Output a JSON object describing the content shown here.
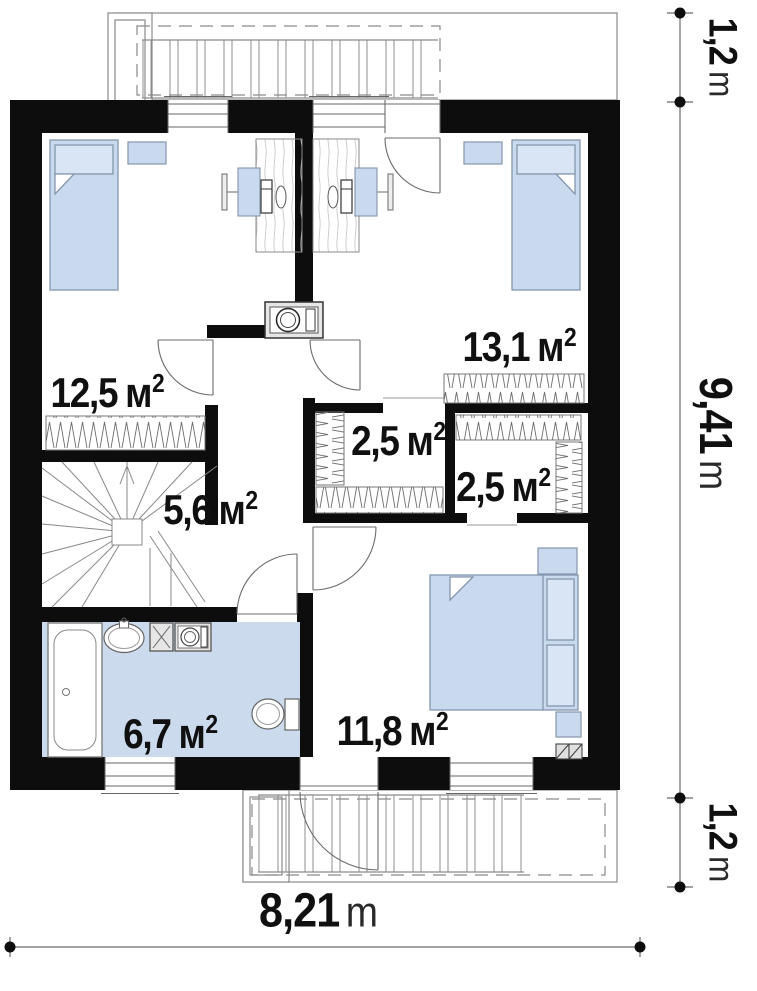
{
  "rooms": [
    {
      "id": "bedroom-top-left",
      "value": "12,5",
      "unit": "м",
      "sup": "2"
    },
    {
      "id": "bedroom-top-right",
      "value": "13,1",
      "unit": "м",
      "sup": "2"
    },
    {
      "id": "closet-left",
      "value": "2,5",
      "unit": "м",
      "sup": "2"
    },
    {
      "id": "closet-right",
      "value": "2,5",
      "unit": "м",
      "sup": "2"
    },
    {
      "id": "hall-stairs",
      "value": "5,6",
      "unit": "м",
      "sup": "2"
    },
    {
      "id": "bathroom",
      "value": "6,7",
      "unit": "м",
      "sup": "2"
    },
    {
      "id": "bedroom-bottom",
      "value": "11,8",
      "unit": "м",
      "sup": "2"
    }
  ],
  "dimensions": {
    "balcony_top_depth": {
      "value": "1,2",
      "unit": "m"
    },
    "house_depth": {
      "value": "9,41",
      "unit": "m"
    },
    "balcony_bottom_depth": {
      "value": "1,2",
      "unit": "m"
    },
    "house_width": {
      "value": "8,21",
      "unit": "m"
    }
  },
  "colors": {
    "wall": "#0d0d0d",
    "furniture_fill": "#c9d9ee",
    "pillow_fill": "#d9e4f4",
    "bathroom_floor": "#ccdaee",
    "thin_line": "#6b6b6b",
    "label_text": "#101010"
  }
}
